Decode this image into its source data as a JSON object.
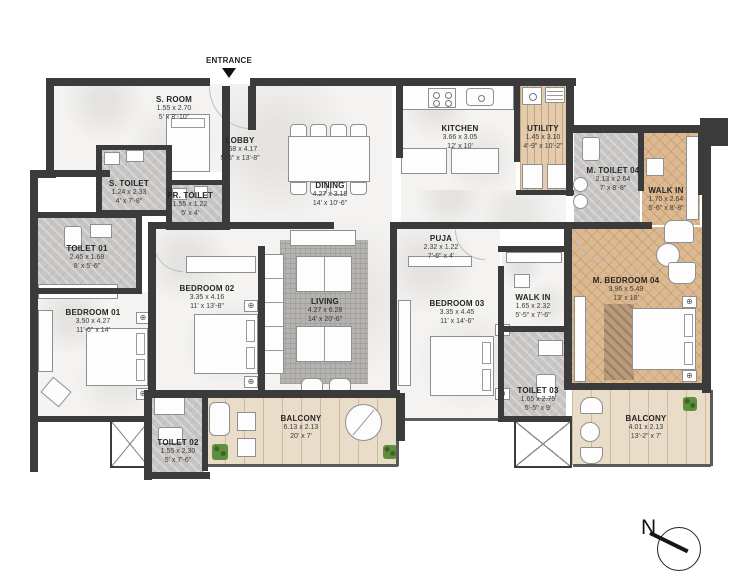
{
  "meta": {
    "entrance_label": "ENTRANCE",
    "north_label": "N"
  },
  "colors": {
    "wall": "#3b3b3b",
    "tile": "#c7c5c3",
    "wood": "#dcb990",
    "deck": "#e9dcc8",
    "marble": "#f4f3f1",
    "plant": "#5f8f3e",
    "rug": "#b5b3b0",
    "text": "#2d2d2d"
  },
  "rooms": {
    "s_room": {
      "name": "S. ROOM",
      "m": "1.55 x 2.70",
      "ft": "5' x 8'-10\""
    },
    "lobby": {
      "name": "LOBBY",
      "m": "1.68 x 4.17",
      "ft": "5'-6\" x 13'-8\""
    },
    "dining": {
      "name": "DINING",
      "m": "4.27 x 3.18",
      "ft": "14' x 10'-6\""
    },
    "kitchen": {
      "name": "KITCHEN",
      "m": "3.66 x 3.05",
      "ft": "12' x 10'"
    },
    "utility": {
      "name": "UTILITY",
      "m": "1.45 x 3.10",
      "ft": "4'-9\" x 10'-2\""
    },
    "m_toilet_04": {
      "name": "M. TOILET 04",
      "m": "2.13 x 2.64",
      "ft": "7' x 8'-8\""
    },
    "walk_in_top": {
      "name": "WALK IN",
      "m": "1.70 x 2.64",
      "ft": "5'-6\" x 8'-8\""
    },
    "s_toilet": {
      "name": "S. TOILET",
      "m": "1.24 x 2.33",
      "ft": "4' x 7'-8\""
    },
    "pr_toilet": {
      "name": "PR. TOILET",
      "m": "1.55 x 1.22",
      "ft": "5' x 4'"
    },
    "toilet_01": {
      "name": "TOILET 01",
      "m": "2.45 x 1.68",
      "ft": "8' x 5'-6\""
    },
    "bedroom_01": {
      "name": "BEDROOM 01",
      "m": "3.50 x 4.27",
      "ft": "11'-6\" x 14'"
    },
    "bedroom_02": {
      "name": "BEDROOM 02",
      "m": "3.35 x 4.16",
      "ft": "11' x 13'-8\""
    },
    "living": {
      "name": "LIVING",
      "m": "4.27 x 6.28",
      "ft": "14' x 20'-6\""
    },
    "puja": {
      "name": "PUJA",
      "m": "2.32 x 1.22",
      "ft": "7'-6\" x 4'"
    },
    "bedroom_03": {
      "name": "BEDROOM 03",
      "m": "3.35 x 4.45",
      "ft": "11' x 14'-6\""
    },
    "walk_in_mid": {
      "name": "WALK IN",
      "m": "1.65 x 2.32",
      "ft": "5'-5\" x 7'-6\""
    },
    "m_bedroom_04": {
      "name": "M. BEDROOM 04",
      "m": "3.96 x 5.49",
      "ft": "13' x 18'"
    },
    "toilet_03": {
      "name": "TOILET 03",
      "m": "1.65 x 2.75",
      "ft": "5'-5\" x 9'"
    },
    "toilet_02": {
      "name": "TOILET 02",
      "m": "1.55 x 2.30",
      "ft": "5' x 7'-6\""
    },
    "balcony_main": {
      "name": "BALCONY",
      "m": "6.13 x 2.13",
      "ft": "20' x 7'"
    },
    "balcony_right": {
      "name": "BALCONY",
      "m": "4.01 x 2.13",
      "ft": "13'-2\" x 7'"
    }
  }
}
